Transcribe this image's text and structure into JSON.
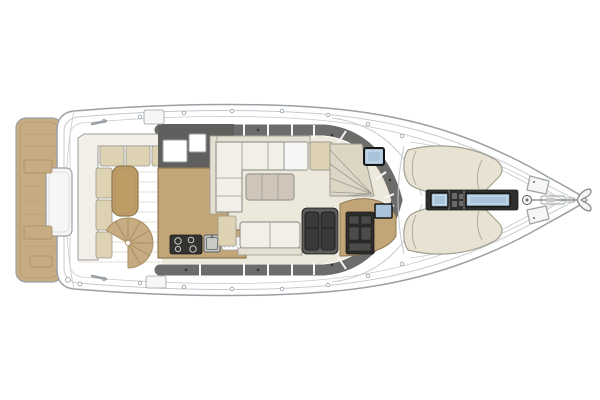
{
  "colors": {
    "background": "#ffffff",
    "white": "#ffffff",
    "fitting": "#f6f6f4",
    "teak": "#c6ac80",
    "teak_seam": "#a88f63",
    "cushion_white": "#f1efe8",
    "cushion_trim": "#e3dfd2",
    "cushion_beige": "#ddd2b2",
    "sunpad": "#e7e2d2",
    "cockpit_table": "#bd9c66",
    "salon_table": "#cfc6b9",
    "salon_floor": "#ece8db",
    "counter": "#c2a678",
    "cabinet_dark": "#5f5f5d",
    "cabin_band": "#6c6c6a",
    "console": "#2d2d2c",
    "seat_dark": "#3a3a38",
    "seat_base": "#5b5b59",
    "stair_tread": "#ddd6c4",
    "hatch_blue": "#a9c4da",
    "walkway_dark": "#2f2f2d",
    "stove": "#333331",
    "instrument": "#4b4b49",
    "detail_gray": "#6a6a68",
    "dot_dark": "#2e2e2e",
    "metal": "#c9c9c5"
  },
  "regions": {
    "swim_platform": "swim platform with storage hatches",
    "transom": "transom with center module",
    "cockpit": "aft cockpit with L-sofa, table, spiral stairs",
    "galley": "galley with stove, sink, drainboard",
    "salon": "salon with L-sofa, table, facing bench",
    "helm": "helm station with double seat and console",
    "companionway": "stairs to lower deck with skylight hatch",
    "foredeck": "twin sun pads with center walkway hatches",
    "bow": "anchor windlass, deck lockers, bow roller"
  }
}
